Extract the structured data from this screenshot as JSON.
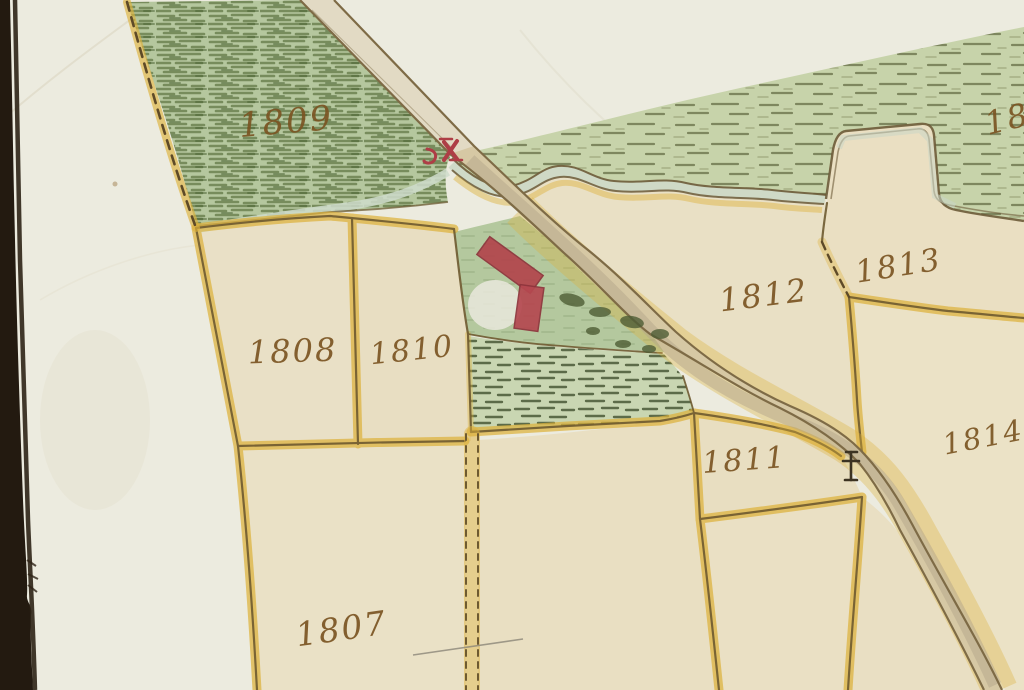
{
  "image": {
    "description": "Photograph of a hand-drawn cadastral map in ink and watercolor on cream paper, dark table edge visible at left",
    "background_color": "#241b10",
    "paper_color": "#ecebdf"
  },
  "map": {
    "parcels": [
      {
        "number": "1807",
        "type": "arable field (beige)"
      },
      {
        "number": "1808",
        "type": "arable field (beige)"
      },
      {
        "number": "1809",
        "type": "meadow (green hatched)"
      },
      {
        "number": "1810",
        "type": "arable field (beige)"
      },
      {
        "number": "1811",
        "type": "arable field (beige)"
      },
      {
        "number": "1812",
        "type": "arable field (beige)"
      },
      {
        "number": "1813",
        "type": "arable field (beige)"
      },
      {
        "number": "1814",
        "type": "arable field (beige)"
      },
      {
        "number": "18",
        "type": "partial parcel number cut off at right edge"
      }
    ],
    "features": {
      "road": "tan road with brown edges and yellow halo crossing diagonally from top center to bottom right",
      "stream": "wavy double-line stream with step-shaped parcel notch, flowing under road at red bridge mark",
      "bridge_mark": "red bridge symbol where road crosses stream",
      "wayside_cross": "small dark cross symbol beside road near parcel 1811",
      "buildings": "two red building rectangles inside green enclosure",
      "trees": "dark green bushes in enclosure",
      "boundaries": "yellow watercolor parcel borders with brown ink lines, some dashed"
    }
  },
  "colors": {
    "parcel_fill": "#e9dfc3",
    "border_yellow": "#ddb23c",
    "ink_brown": "#6e5a30",
    "meadow_green": "#b5c79e",
    "hatch_green": "#5d7440",
    "building_red": "#b2454c",
    "label_brown": "#7b5523"
  }
}
